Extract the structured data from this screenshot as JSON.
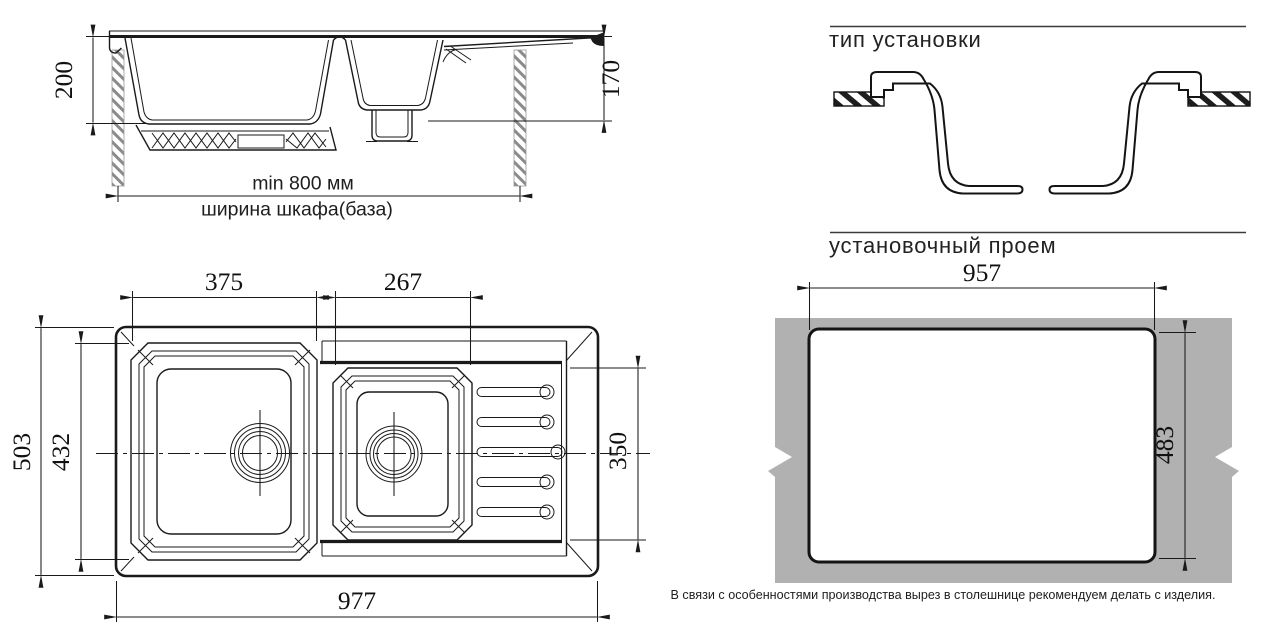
{
  "side_view": {
    "depth_main": "200",
    "depth_small": "170",
    "min_cabinet_width": "min 800 мм",
    "cabinet_width_label": "ширина шкафа(база)"
  },
  "plan_view": {
    "main_bowl_width": "375",
    "small_bowl_width": "267",
    "overall_depth": "503",
    "main_bowl_depth": "432",
    "drainboard_depth": "350",
    "overall_width": "977"
  },
  "installation": {
    "title": "тип установки"
  },
  "cutout": {
    "title": "установочный проем",
    "width": "957",
    "depth": "483",
    "note": "В связи с особенностями производства вырез в столешнице рекомендуем делать с изделия."
  },
  "colors": {
    "line": "#1a1a1a",
    "countertop_gray": "#b1b1b1",
    "hatch_gray": "#8a8a8a"
  }
}
